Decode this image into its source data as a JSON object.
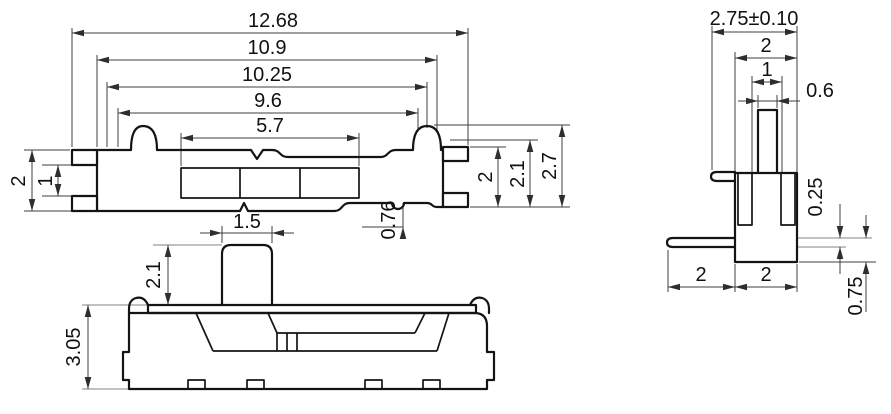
{
  "drawing": {
    "type": "engineering-dimension-drawing",
    "background_color": "#ffffff",
    "outline_color": "#141414",
    "dimension_line_color": "#3f3f3f",
    "reference_line_color": "#9c9c9c",
    "text_color": "#111111"
  },
  "dimensions": {
    "top_view": {
      "overall_length": "12.68",
      "length_b": "10.9",
      "length_c": "10.25",
      "length_d": "9.6",
      "slot_length": "5.7",
      "left_terminal_span": "2",
      "left_terminal_gap": "1",
      "right_terminal_span": "2",
      "body_width": "2.1",
      "overall_width": "2.7",
      "notch_offset": "0.76"
    },
    "front_view": {
      "knob_width": "1.5",
      "knob_height": "2.1",
      "body_height": "3.05"
    },
    "side_view": {
      "overall_width": "2.75±0.10",
      "body_width": "2",
      "inner_width": "1",
      "knob_width": "0.6",
      "pin_thickness": "0.25",
      "pin_drop": "0.75",
      "pin_length": "2",
      "body_depth": "2"
    }
  }
}
